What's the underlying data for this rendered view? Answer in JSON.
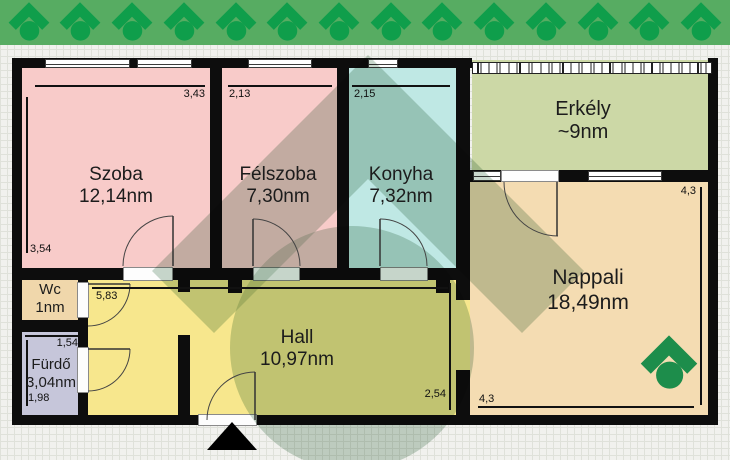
{
  "page": {
    "type": "apartment floor plan"
  },
  "banner": {
    "icon_name": "roof-house-logo",
    "icon_count": 14
  },
  "colors": {
    "banner_bg": "#57ac62",
    "banner_icon": "#0f9e4b",
    "corner_logo": "#1d8d4b",
    "watermark": "#6e9678",
    "wall": "#0d0d0d",
    "paper": "#f1f1ee"
  },
  "rooms": {
    "szoba": {
      "name": "Szoba",
      "area": "12,14nm",
      "width_m": "3,43",
      "height_m": "3,54",
      "color": "#f8cbc9"
    },
    "felszoba": {
      "name": "Félszoba",
      "area": "7,30nm",
      "width_m": "2,13",
      "color": "#f8cbc9"
    },
    "konyha": {
      "name": "Konyha",
      "area": "7,32nm",
      "width_m": "2,15",
      "color": "#bfe8e4"
    },
    "erkely": {
      "name": "Erkély",
      "area": "~9nm",
      "color": "#ccd8a6"
    },
    "nappali": {
      "name": "Nappali",
      "area": "18,49nm",
      "width_m": "4,3",
      "height_m": "4,3",
      "color": "#f4dcb2"
    },
    "wc": {
      "name": "Wc",
      "area": "1nm",
      "color": "#f0d7ab"
    },
    "furdo": {
      "name": "Fürdő",
      "area": "3,04nm",
      "width_m": "1,54",
      "height_m": "1,98",
      "color": "#c6c6da"
    },
    "hall": {
      "name": "Hall",
      "area": "10,97nm",
      "width_m": "5,83",
      "height_m": "2,54",
      "color": "#f7e78d"
    }
  }
}
